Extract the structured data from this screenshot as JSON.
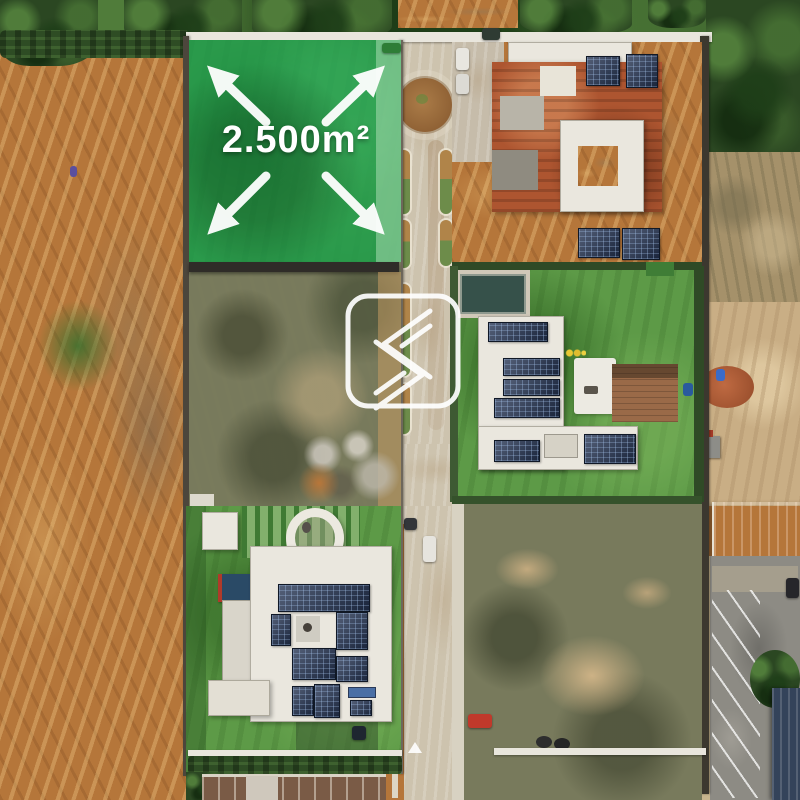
{
  "scene": {
    "description": "Aerial drone photo of a gated residential development with a highlighted lot for sale",
    "area_label": "2.500m²"
  },
  "overlay": {
    "area_label": "2.500m²",
    "fill_color": "#1e9a4c",
    "label_color": "#ffffff",
    "icon": "expand-arrows"
  },
  "watermark": {
    "icon": "angular-s-logo",
    "color": "#ffffff"
  },
  "palette": {
    "overlay_green": "#1e9a4c",
    "label_white": "#ffffff",
    "dirt_orange": "#b5763a",
    "lawn_green": "#5d9a47",
    "scrub_olive": "#787a5c",
    "road_concrete": "#cdc3ae",
    "asphalt_gray": "#8d8b84",
    "tree_green": "#2b4722",
    "brick_red": "#ad5530",
    "solar_panel_navy": "#243352",
    "white_roof": "#eae7de",
    "tile_roof_red": "#b3532e",
    "navy_roof": "#34435a",
    "sand_tan": "#c9ae85"
  }
}
